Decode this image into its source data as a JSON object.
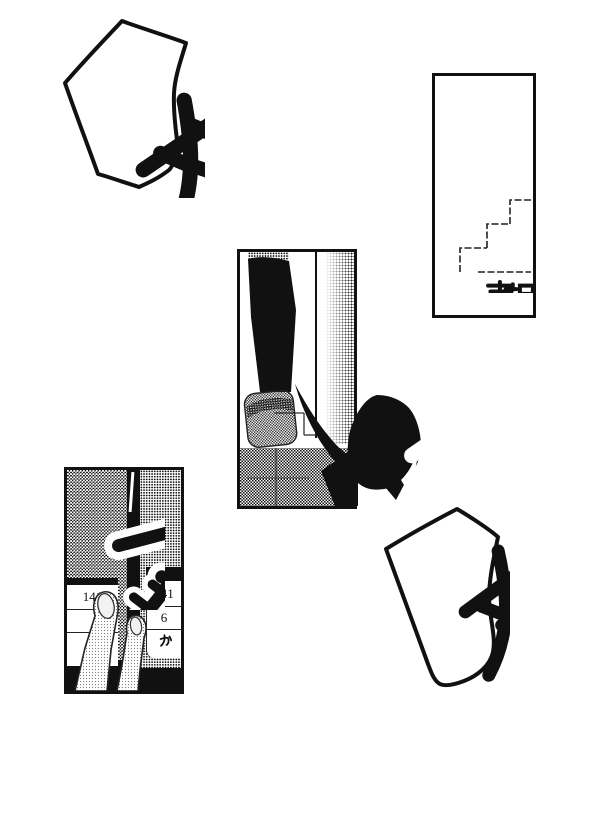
{
  "page": {
    "title": "manga page",
    "paper_color": "#ffffff",
    "ink_color": "#111111"
  },
  "sfx": {
    "katsun_top_left": "カツン",
    "katsun_bottom_right": "カツン",
    "gii": "ギイ",
    "sutsu": "スッ"
  },
  "bookshelf_panel": {
    "sign": "書架"
  },
  "spine_panel": {
    "left_spine_label": "141",
    "right_spine_labels": [
      "141",
      "6",
      "か"
    ]
  }
}
